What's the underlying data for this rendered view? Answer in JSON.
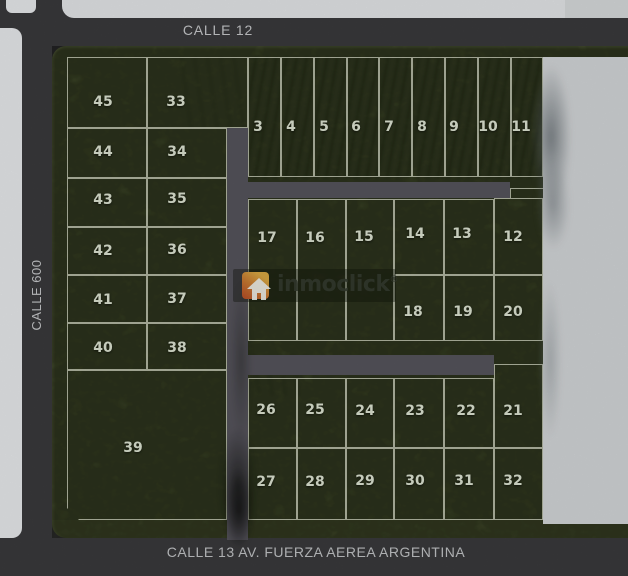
{
  "map": {
    "title": "Lot subdivision plan",
    "streets": {
      "top": "CALLE 12",
      "left": "CALLE 600",
      "bottom": "CALLE 13 AV. FUERZA AEREA ARGENTINA"
    },
    "watermark": {
      "brand": "inmoclick",
      "registered": "®",
      "icon": "house-arrow-icon"
    },
    "colors": {
      "street": "#3a3a3c",
      "block_green": "#4a5530",
      "internal_road": "#56545c",
      "lot_line": "#e4e9d6",
      "lot_number": "#dde3d2",
      "reserved_area": "#d3d6d8",
      "adjacent_block": "#e8eaec",
      "logo_orange": "#d8a843",
      "logo_red": "#b95529"
    },
    "roads": [
      {
        "id": "road-vertical",
        "x": 227,
        "y": 128,
        "w": 21,
        "h": 412
      },
      {
        "id": "road-h-upper",
        "x": 246,
        "y": 182,
        "w": 264,
        "h": 16
      },
      {
        "id": "road-h-lower",
        "x": 246,
        "y": 355,
        "w": 248,
        "h": 20
      }
    ],
    "lots": [
      {
        "n": "45",
        "x": 67,
        "y": 57,
        "w": 80,
        "h": 71,
        "lx": 103,
        "ly": 102
      },
      {
        "n": "33",
        "x": 147,
        "y": 57,
        "w": 101,
        "h": 71,
        "lx": 176,
        "ly": 102
      },
      {
        "n": "44",
        "x": 67,
        "y": 128,
        "w": 80,
        "h": 50,
        "lx": 103,
        "ly": 152
      },
      {
        "n": "34",
        "x": 147,
        "y": 128,
        "w": 80,
        "h": 50,
        "lx": 177,
        "ly": 152
      },
      {
        "n": "43",
        "x": 67,
        "y": 178,
        "w": 80,
        "h": 49,
        "lx": 103,
        "ly": 200
      },
      {
        "n": "35",
        "x": 147,
        "y": 178,
        "w": 80,
        "h": 49,
        "lx": 177,
        "ly": 199
      },
      {
        "n": "42",
        "x": 67,
        "y": 227,
        "w": 80,
        "h": 48,
        "lx": 103,
        "ly": 251
      },
      {
        "n": "36",
        "x": 147,
        "y": 227,
        "w": 80,
        "h": 48,
        "lx": 177,
        "ly": 250
      },
      {
        "n": "41",
        "x": 67,
        "y": 275,
        "w": 80,
        "h": 48,
        "lx": 103,
        "ly": 300
      },
      {
        "n": "37",
        "x": 147,
        "y": 275,
        "w": 80,
        "h": 48,
        "lx": 177,
        "ly": 299
      },
      {
        "n": "40",
        "x": 67,
        "y": 323,
        "w": 80,
        "h": 47,
        "lx": 103,
        "ly": 348
      },
      {
        "n": "38",
        "x": 147,
        "y": 323,
        "w": 80,
        "h": 47,
        "lx": 177,
        "ly": 348
      },
      {
        "n": "39",
        "x": 67,
        "y": 370,
        "w": 160,
        "h": 150,
        "lx": 133,
        "ly": 448,
        "ch": true
      },
      {
        "n": "3",
        "x": 248,
        "y": 57,
        "w": 33,
        "h": 120,
        "lx": 258,
        "ly": 127
      },
      {
        "n": "4",
        "x": 281,
        "y": 57,
        "w": 33,
        "h": 120,
        "lx": 291,
        "ly": 127
      },
      {
        "n": "5",
        "x": 314,
        "y": 57,
        "w": 33,
        "h": 120,
        "lx": 324,
        "ly": 127
      },
      {
        "n": "6",
        "x": 347,
        "y": 57,
        "w": 32,
        "h": 120,
        "lx": 356,
        "ly": 127
      },
      {
        "n": "7",
        "x": 379,
        "y": 57,
        "w": 33,
        "h": 120,
        "lx": 389,
        "ly": 127
      },
      {
        "n": "8",
        "x": 412,
        "y": 57,
        "w": 33,
        "h": 120,
        "lx": 422,
        "ly": 127
      },
      {
        "n": "9",
        "x": 445,
        "y": 57,
        "w": 33,
        "h": 120,
        "lx": 454,
        "ly": 127
      },
      {
        "n": "10",
        "x": 478,
        "y": 57,
        "w": 33,
        "h": 120,
        "lx": 488,
        "ly": 127
      },
      {
        "n": "11",
        "x": 511,
        "y": 57,
        "w": 32,
        "h": 120,
        "lx": 521,
        "ly": 127
      },
      {
        "n": "17",
        "x": 248,
        "y": 199,
        "w": 49,
        "h": 142,
        "lx": 267,
        "ly": 238
      },
      {
        "n": "16",
        "x": 297,
        "y": 199,
        "w": 49,
        "h": 142,
        "lx": 315,
        "ly": 238
      },
      {
        "n": "15",
        "x": 346,
        "y": 199,
        "w": 48,
        "h": 142,
        "lx": 364,
        "ly": 237
      },
      {
        "n": "14",
        "x": 394,
        "y": 199,
        "w": 50,
        "h": 76,
        "lx": 415,
        "ly": 234
      },
      {
        "n": "13",
        "x": 444,
        "y": 199,
        "w": 50,
        "h": 76,
        "lx": 462,
        "ly": 234
      },
      {
        "n": "12",
        "x": 494,
        "y": 198,
        "w": 49,
        "h": 77,
        "lx": 513,
        "ly": 237
      },
      {
        "n": "18",
        "x": 394,
        "y": 275,
        "w": 50,
        "h": 66,
        "lx": 413,
        "ly": 312
      },
      {
        "n": "19",
        "x": 444,
        "y": 275,
        "w": 50,
        "h": 66,
        "lx": 463,
        "ly": 312
      },
      {
        "n": "20",
        "x": 494,
        "y": 275,
        "w": 49,
        "h": 66,
        "lx": 513,
        "ly": 312
      },
      {
        "n": "26",
        "x": 248,
        "y": 378,
        "w": 49,
        "h": 70,
        "lx": 266,
        "ly": 410
      },
      {
        "n": "25",
        "x": 297,
        "y": 378,
        "w": 49,
        "h": 70,
        "lx": 315,
        "ly": 410
      },
      {
        "n": "24",
        "x": 346,
        "y": 378,
        "w": 48,
        "h": 70,
        "lx": 365,
        "ly": 411
      },
      {
        "n": "23",
        "x": 394,
        "y": 378,
        "w": 50,
        "h": 70,
        "lx": 415,
        "ly": 411
      },
      {
        "n": "22",
        "x": 444,
        "y": 378,
        "w": 50,
        "h": 70,
        "lx": 466,
        "ly": 411
      },
      {
        "n": "21",
        "x": 494,
        "y": 364,
        "w": 49,
        "h": 84,
        "lx": 513,
        "ly": 411
      },
      {
        "n": "27",
        "x": 248,
        "y": 448,
        "w": 49,
        "h": 72,
        "lx": 266,
        "ly": 482
      },
      {
        "n": "28",
        "x": 297,
        "y": 448,
        "w": 49,
        "h": 72,
        "lx": 315,
        "ly": 482
      },
      {
        "n": "29",
        "x": 346,
        "y": 448,
        "w": 48,
        "h": 72,
        "lx": 365,
        "ly": 481
      },
      {
        "n": "30",
        "x": 394,
        "y": 448,
        "w": 50,
        "h": 72,
        "lx": 415,
        "ly": 481
      },
      {
        "n": "31",
        "x": 444,
        "y": 448,
        "w": 50,
        "h": 72,
        "lx": 464,
        "ly": 481
      },
      {
        "n": "32",
        "x": 494,
        "y": 448,
        "w": 49,
        "h": 72,
        "lx": 513,
        "ly": 481
      }
    ]
  }
}
